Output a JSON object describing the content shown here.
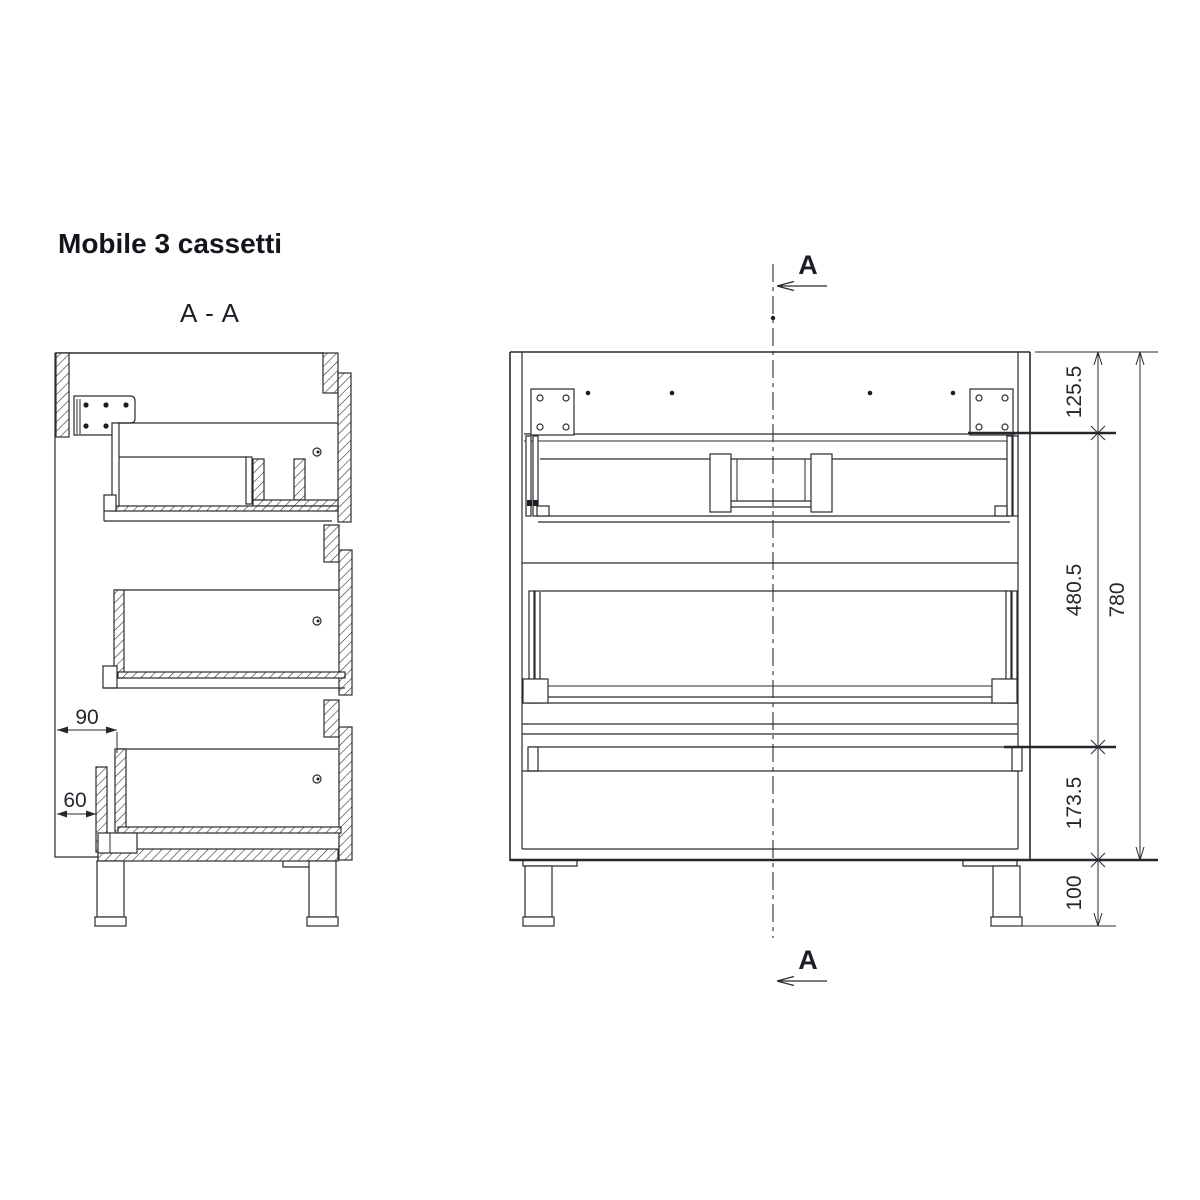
{
  "title": "Mobile 3 cassetti",
  "section_view": {
    "label": "A - A",
    "dimensions": [
      {
        "id": "back-offset",
        "label": "90"
      },
      {
        "id": "rail-offset",
        "label": "60"
      }
    ]
  },
  "front_view": {
    "cut_line_label_top": "A",
    "cut_line_label_bottom": "A",
    "dimensions": [
      {
        "id": "top-section-height",
        "label": "125.5"
      },
      {
        "id": "middle-section-height",
        "label": "480.5"
      },
      {
        "id": "bottom-section-height",
        "label": "173.5"
      },
      {
        "id": "leg-height",
        "label": "100"
      },
      {
        "id": "body-height",
        "label": "780"
      }
    ]
  },
  "colors": {
    "background": "#ffffff",
    "line": "#2b2b31",
    "text": "#1d1d26"
  }
}
